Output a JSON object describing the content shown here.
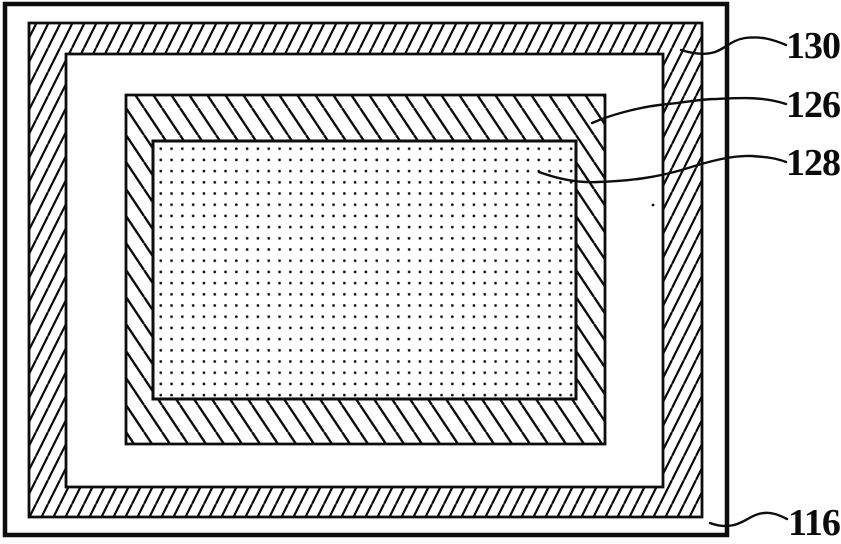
{
  "figure": {
    "background_color": "#ffffff",
    "ink_color": "#0d0d0d",
    "callouts": [
      {
        "label": "130",
        "target": "outer-hatched-frame"
      },
      {
        "label": "126",
        "target": "inner-hatched-frame"
      },
      {
        "label": "128",
        "target": "stippled-region"
      },
      {
        "label": "116",
        "target": "outer-border-panel"
      }
    ],
    "patterns": {
      "outer_frame_hatch": "diagonal-hatch-forward",
      "inner_frame_hatch": "diagonal-hatch-backward",
      "center_fill": "dot-stipple"
    }
  }
}
